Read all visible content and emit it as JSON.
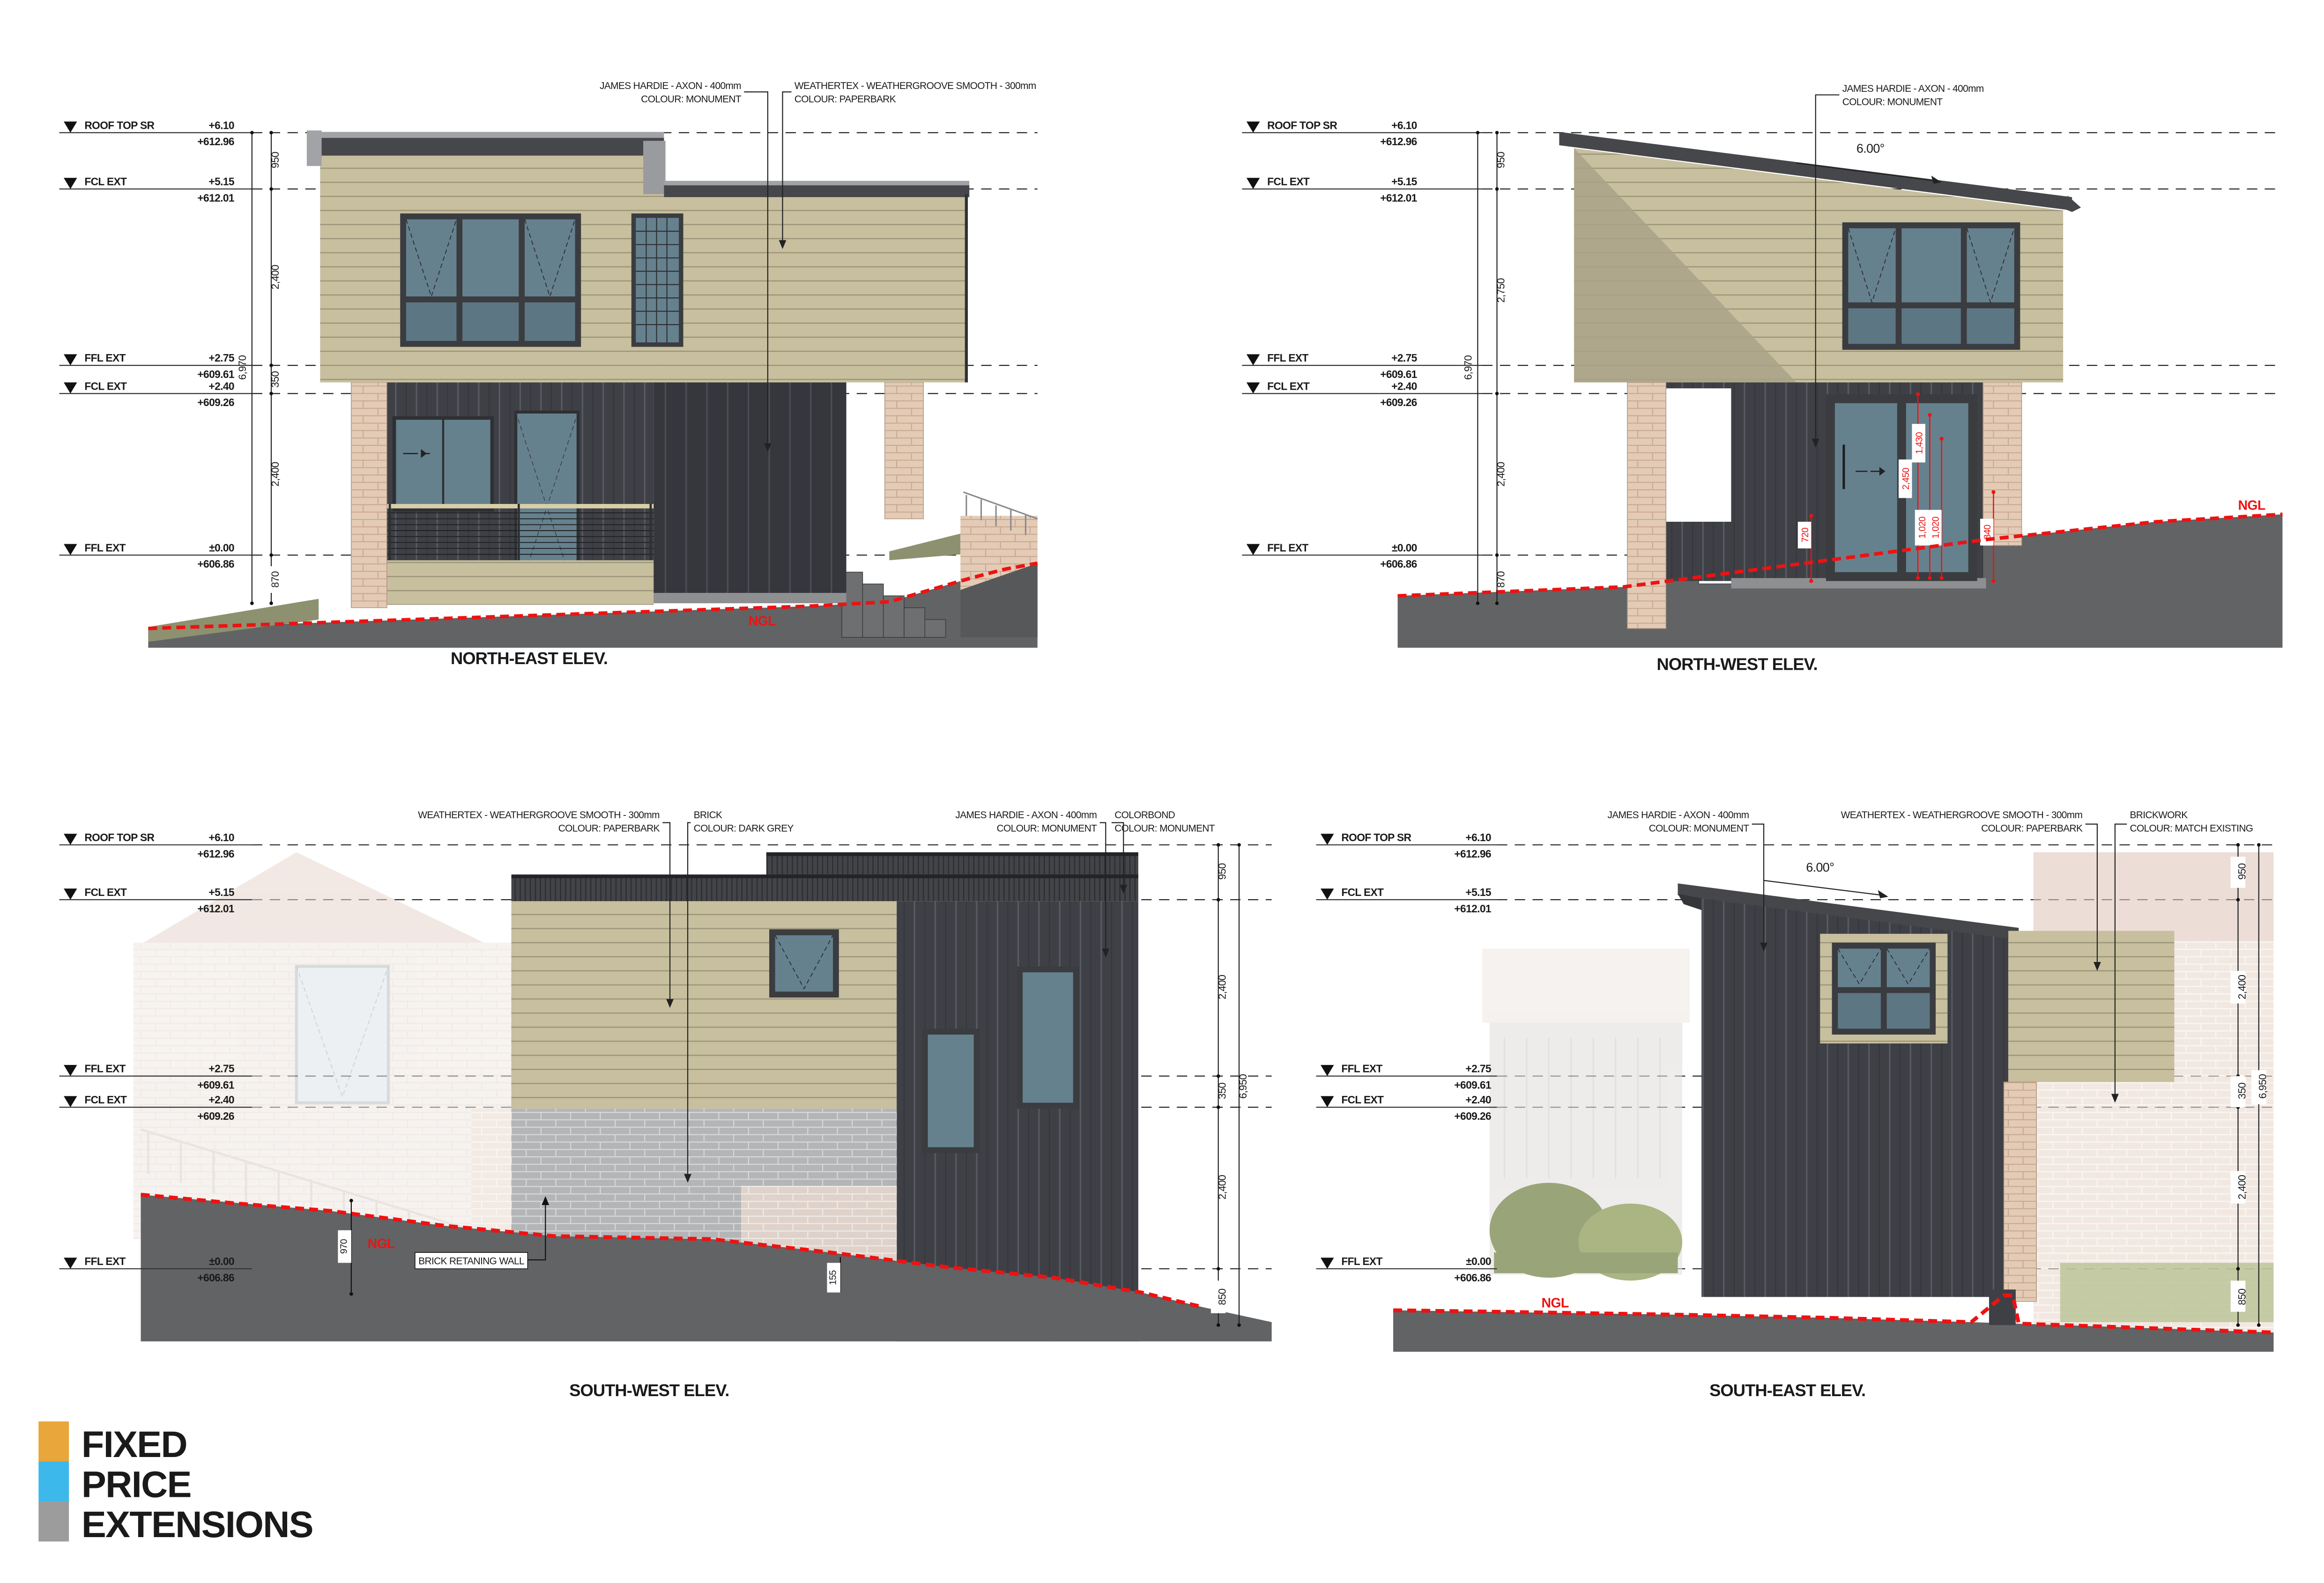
{
  "sheet": {
    "background": "#ffffff"
  },
  "colors": {
    "cladding_paperbark": "#c7bf9e",
    "cladding_paperbark_shade": "#b3ab8c",
    "cladding_monument_dark": "#3e4046",
    "roof_dark": "#46474b",
    "parapet_grey": "#a2a3a6",
    "brick_pink": "#e3cbb6",
    "brick_grey": "#b9babb",
    "glass_blue": "#66818e",
    "ground_grey": "#626365",
    "grass_olive": "#8d9170",
    "ngl_red": "#ee1212",
    "logo_orange": "#e9a63b",
    "logo_blue": "#3cb9ea",
    "logo_grey": "#9c9c9c"
  },
  "levels": [
    {
      "name": "ROOF TOP SR",
      "lvl": "+6.10",
      "rl": "+612.96"
    },
    {
      "name": "FCL EXT",
      "lvl": "+5.15",
      "rl": "+612.01"
    },
    {
      "name": "FFL EXT",
      "lvl": "+2.75",
      "rl": "+609.61"
    },
    {
      "name": "FCL EXT",
      "lvl": "+2.40",
      "rl": "+609.26"
    },
    {
      "name": "FFL EXT",
      "lvl": "±0.00",
      "rl": "+606.86"
    }
  ],
  "ne": {
    "title": "NORTH-EAST ELEV.",
    "ngl": "NGL",
    "callouts": [
      {
        "l1": "JAMES HARDIE - AXON - 400mm",
        "l2": "COLOUR: MONUMENT"
      },
      {
        "l1": "WEATHERTEX - WEATHERGROOVE SMOOTH - 300mm",
        "l2": "COLOUR: PAPERBARK"
      }
    ],
    "dims": {
      "total": "6,970",
      "segs": [
        "950",
        "2,400",
        "350",
        "2,400",
        "870"
      ]
    }
  },
  "nw": {
    "title": "NORTH-WEST ELEV.",
    "ngl": "NGL",
    "angle": "6.00°",
    "callouts": [
      {
        "l1": "JAMES HARDIE - AXON - 400mm",
        "l2": "COLOUR: MONUMENT"
      }
    ],
    "dims": {
      "total": "6,970",
      "segs": [
        "950",
        "2,750",
        "2,400",
        "870"
      ]
    },
    "red_dims": [
      "720",
      "2,450",
      "1,430",
      "1,020",
      "1,020",
      "840"
    ]
  },
  "sw": {
    "title": "SOUTH-WEST ELEV.",
    "ngl": "NGL",
    "retaining_label": "BRICK RETANING WALL",
    "dim_970": "970",
    "dim_155": "155",
    "callouts": [
      {
        "l1": "WEATHERTEX - WEATHERGROOVE SMOOTH - 300mm",
        "l2": "COLOUR: PAPERBARK"
      },
      {
        "l1": "BRICK",
        "l2": "COLOUR: DARK GREY"
      },
      {
        "l1": "JAMES HARDIE - AXON - 400mm",
        "l2": "COLOUR: MONUMENT"
      },
      {
        "l1": "COLORBOND",
        "l2": "COLOUR: MONUMENT"
      }
    ],
    "dims": {
      "total": "6,950",
      "segs": [
        "950",
        "2,400",
        "350",
        "2,400",
        "850"
      ]
    }
  },
  "se": {
    "title": "SOUTH-EAST ELEV.",
    "ngl": "NGL",
    "angle": "6.00°",
    "callouts": [
      {
        "l1": "JAMES HARDIE - AXON - 400mm",
        "l2": "COLOUR: MONUMENT"
      },
      {
        "l1": "WEATHERTEX - WEATHERGROOVE SMOOTH - 300mm",
        "l2": "COLOUR: PAPERBARK"
      },
      {
        "l1": "BRICKWORK",
        "l2": "COLOUR: MATCH EXISTING"
      }
    ],
    "dims": {
      "total": "6,950",
      "segs": [
        "950",
        "2,400",
        "350",
        "2,400",
        "850"
      ]
    }
  },
  "logo": {
    "fixed": "FIXED",
    "price": "PRICE",
    "extensions": "EXTENSIONS"
  }
}
